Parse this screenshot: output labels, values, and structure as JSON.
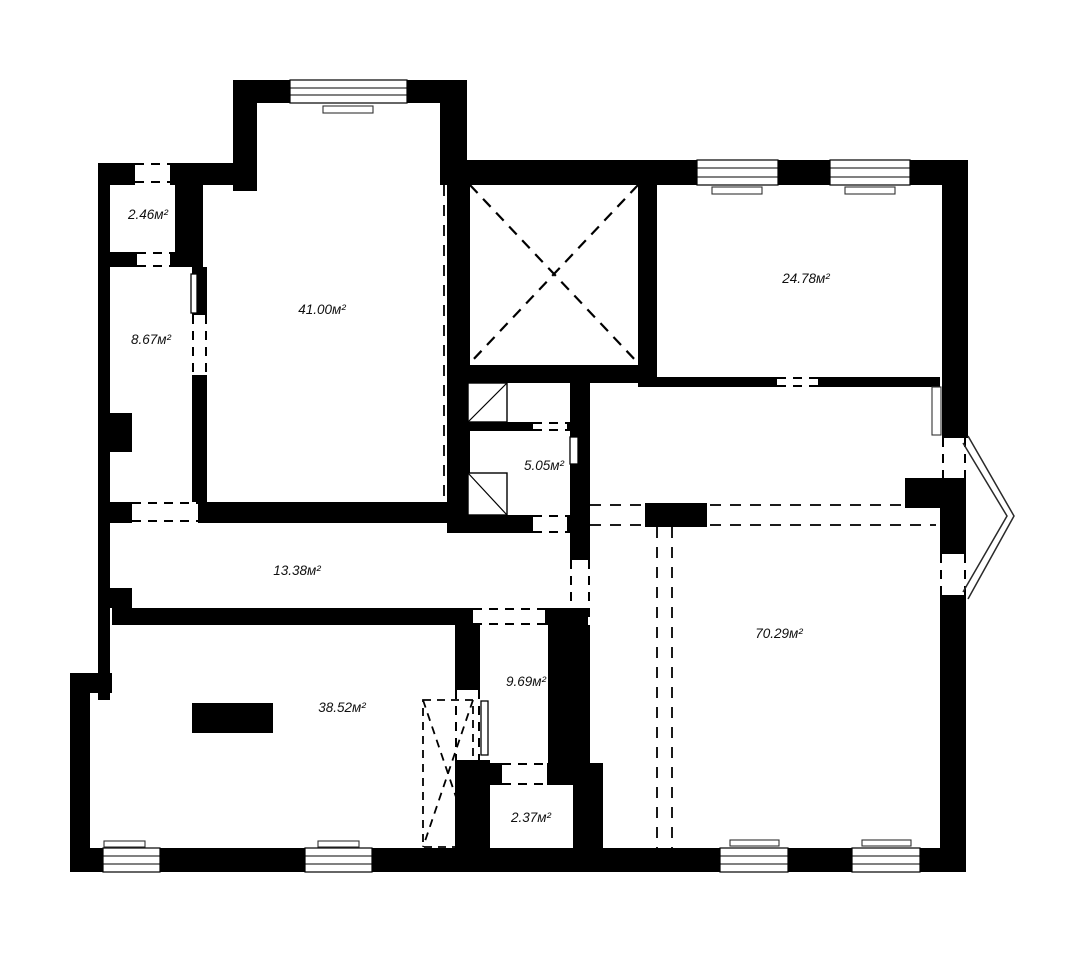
{
  "plan": {
    "type": "apartment-floor-plan",
    "colors": {
      "wall": "#000000",
      "background": "#ffffff",
      "line": "#1a1a1a"
    },
    "rooms": [
      {
        "area": "2.46м²"
      },
      {
        "area": "8.67м²"
      },
      {
        "area": "41.00м²"
      },
      {
        "area": "24.78м²"
      },
      {
        "area": "5.05м²"
      },
      {
        "area": "13.38м²"
      },
      {
        "area": "70.29м²"
      },
      {
        "area": "38.52м²"
      },
      {
        "area": "9.69м²"
      },
      {
        "area": "2.37м²"
      }
    ]
  }
}
